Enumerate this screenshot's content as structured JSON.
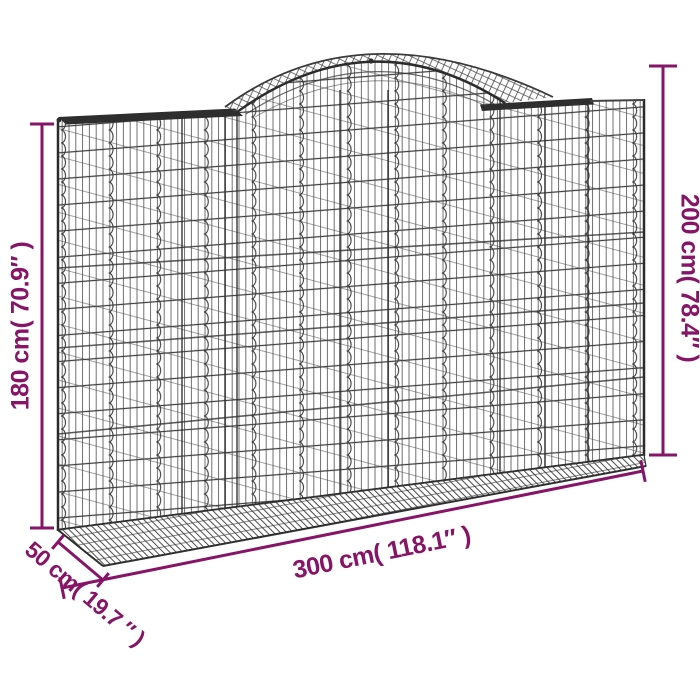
{
  "figure": {
    "type": "product-dimension-diagram",
    "subject": "arched gabion wire mesh basket"
  },
  "dimensions": {
    "left_height": {
      "label": "180 cm( 70.9″ )"
    },
    "right_height": {
      "label": "200 cm( 78.4″ )"
    },
    "bottom_width": {
      "label": "300 cm( 118.1″ )"
    },
    "depth": {
      "label": "50 cm( 19.7 ″ )"
    }
  },
  "palette": {
    "annotation_purple": "#861567",
    "mesh_gray": "#3f3f3f",
    "mesh_dark": "#2b2b2b",
    "background": "#ffffff"
  }
}
